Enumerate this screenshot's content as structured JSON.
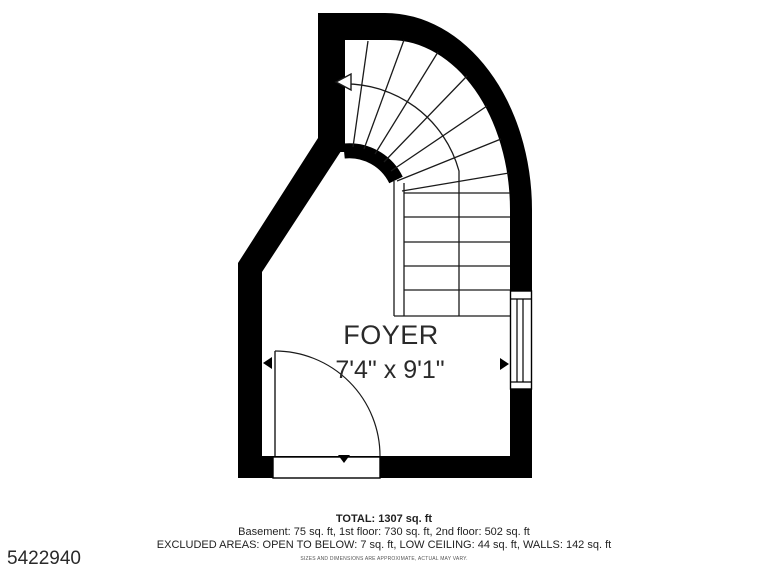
{
  "plan": {
    "room_label": "FOYER",
    "room_dimensions": "7'4\" x 9'1\"",
    "footer": {
      "total": "TOTAL: 1307 sq. ft",
      "floor_breakdown": "Basement: 75 sq. ft, 1st floor: 730 sq. ft, 2nd floor: 502 sq. ft",
      "excluded_areas": "EXCLUDED AREAS: OPEN TO BELOW: 7 sq. ft, LOW CEILING: 44 sq. ft, WALLS: 142 sq. ft",
      "disclaimer": "SIZES AND DIMENSIONS ARE APPROXIMATE, ACTUAL MAY VARY."
    },
    "listing_id": "5422940",
    "colors": {
      "wall": "#000000",
      "line": "#1a1a1a",
      "text": "#2a2a2a",
      "background": "#ffffff"
    }
  }
}
